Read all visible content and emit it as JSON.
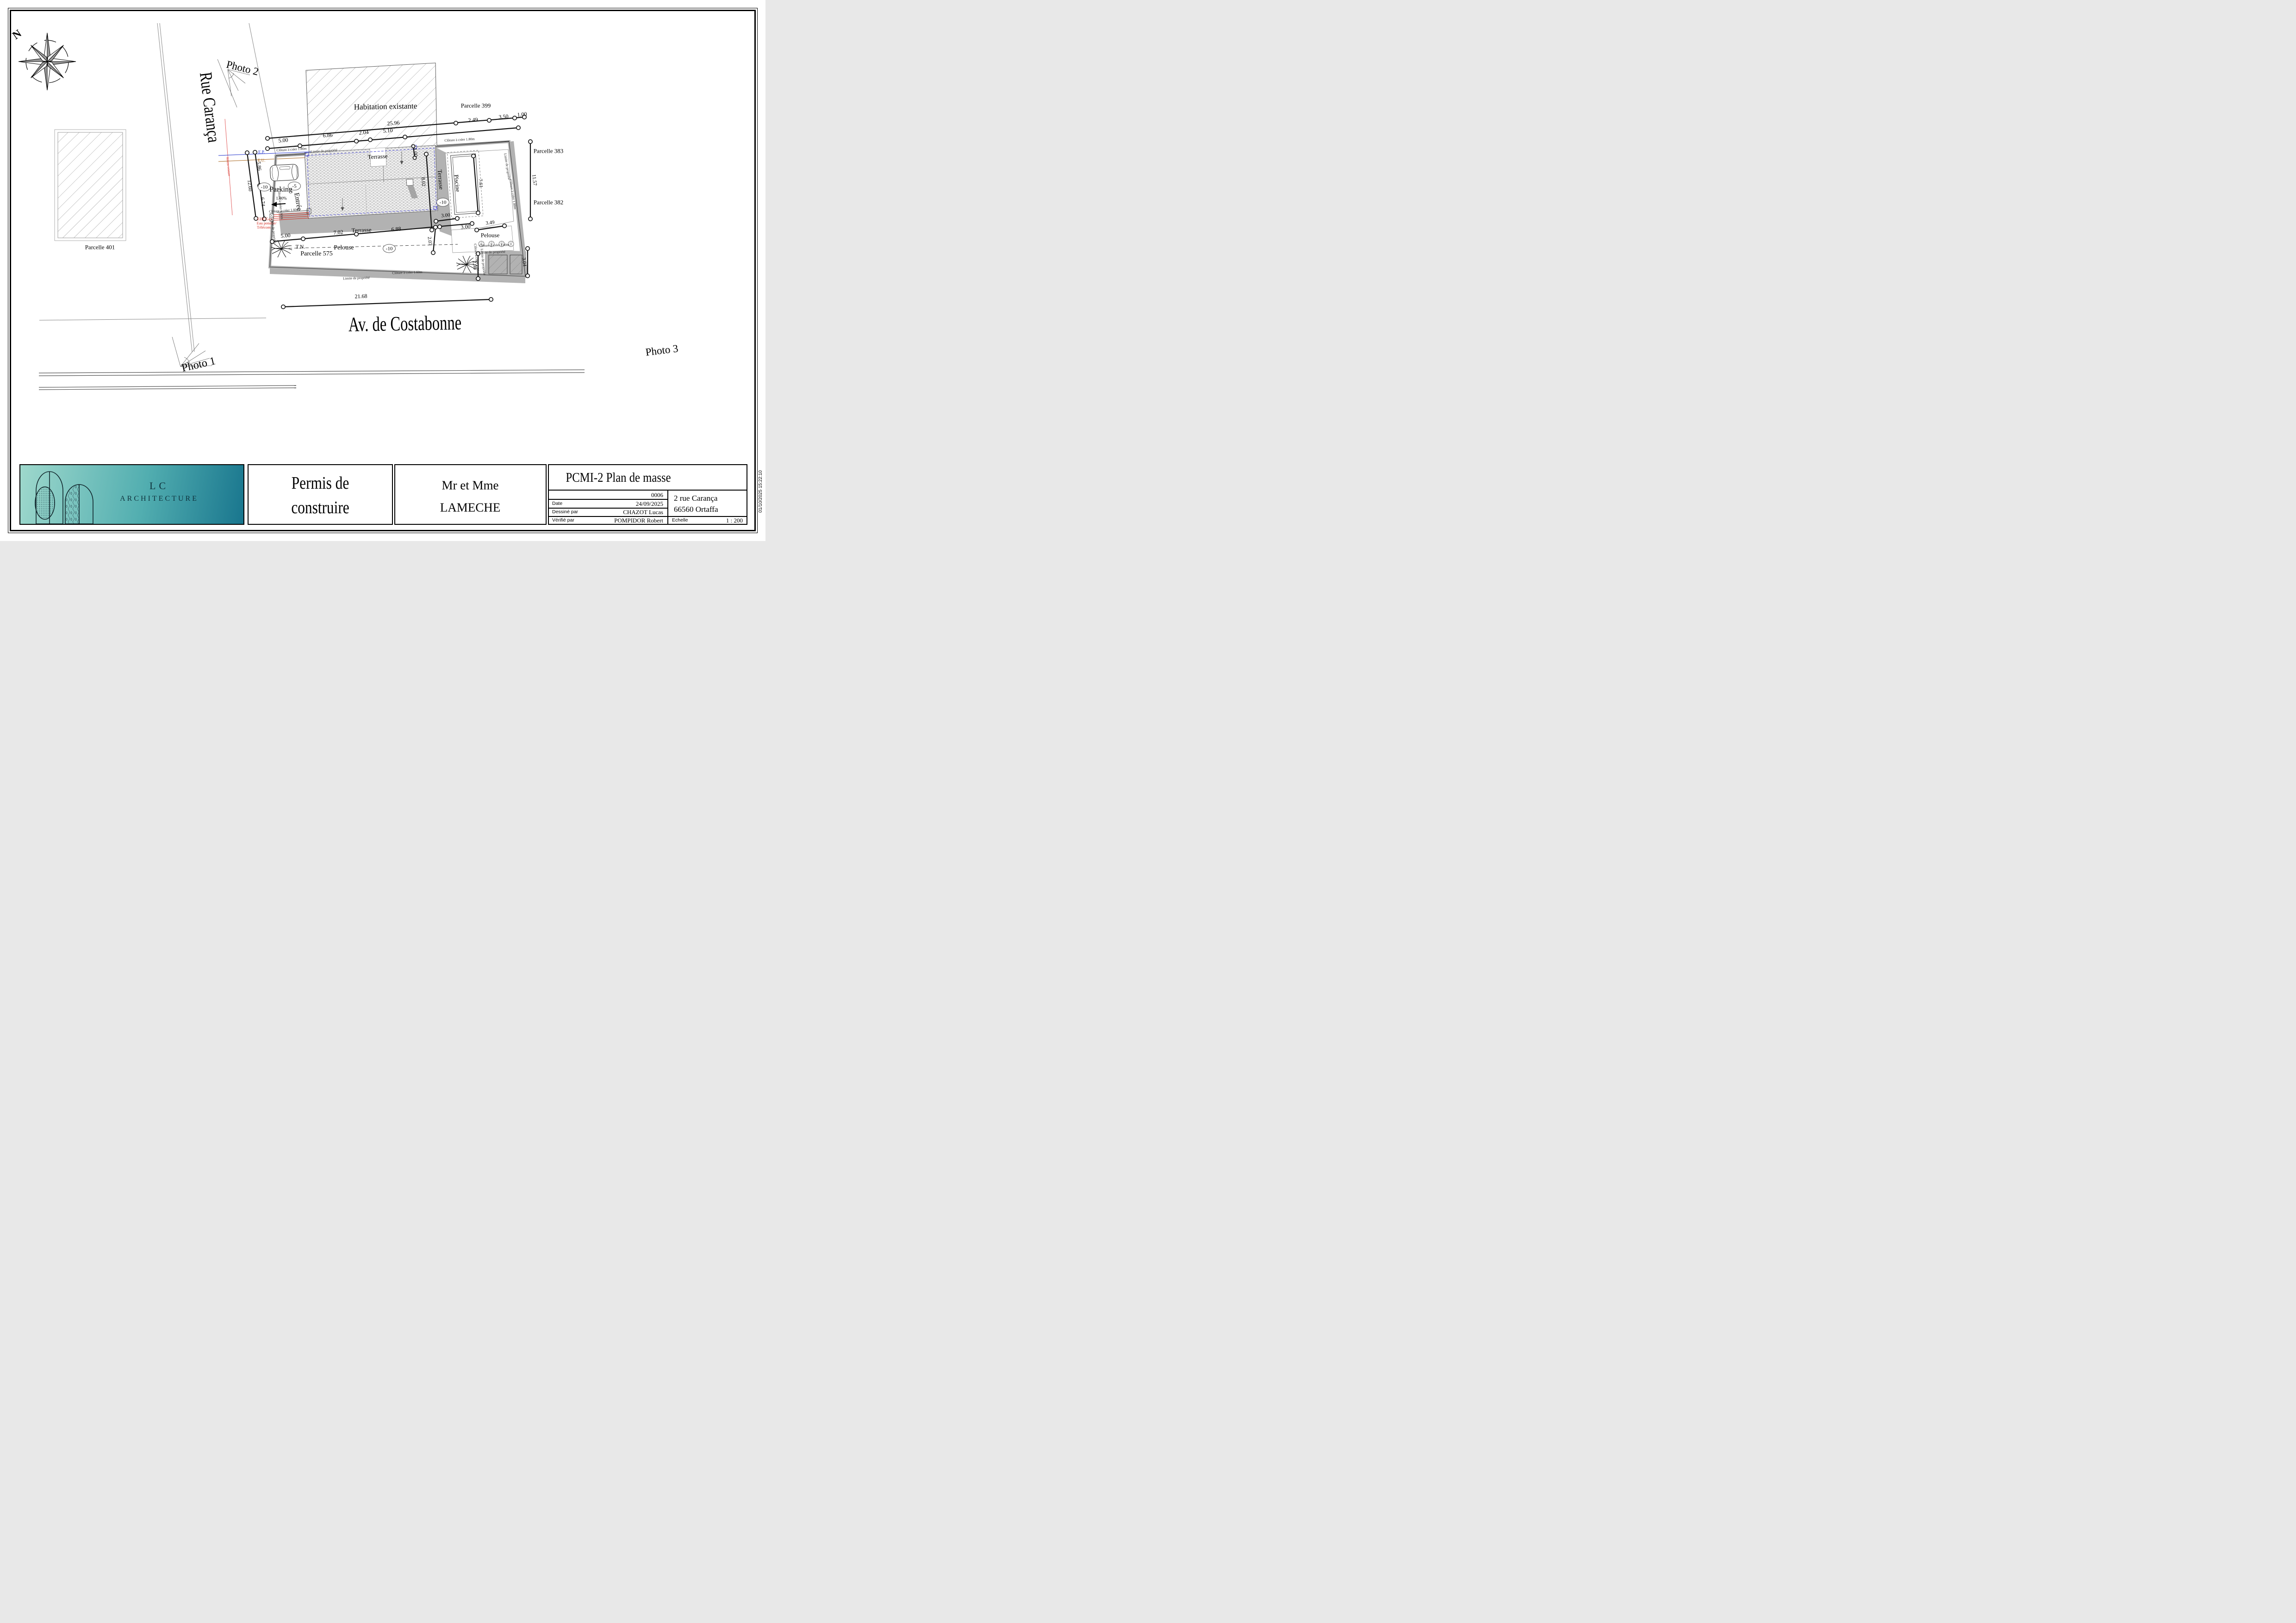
{
  "meta": {
    "timestamp": "01/10/2025 15:22:10"
  },
  "compass": {
    "north": "N"
  },
  "streets": {
    "rue_caranca": "Rue Carança",
    "av_costabonne": "Av. de Costabonne"
  },
  "photos": {
    "p1": "Photo 1",
    "p2": "Photo 2",
    "p3": "Photo 3"
  },
  "parcels": {
    "p399": "Parcelle 399",
    "p383": "Parcelle 383",
    "p382": "Parcelle 382",
    "p401": "Parcelle 401",
    "p575": "Parcelle 575"
  },
  "labels": {
    "habitation": "Habitation existante",
    "terrasse": "Terrasse",
    "parking": "Parking",
    "entree": "Entrée",
    "piscine": "Piscine",
    "pelouse": "Pelouse",
    "tn": "T.N.",
    "slope": "1.00%",
    "level_m10": "-10",
    "level_m5": "-5",
    "cloture_180": "Clôture à créer 1.80m",
    "cloture_160": "Clôture à créer 1.60m",
    "limite": "Limite de propriété",
    "ep": "E.P.",
    "eu": "E.U.",
    "edf": "EDF/Gaz/",
    "eau": "Eau potable/",
    "telecom": "Télécom",
    "reseau": "Réseau existant"
  },
  "dims": {
    "d2596": "25.96",
    "d500": "5.00",
    "d686": "6.86",
    "d204": "2.04",
    "d510": "5.10",
    "d249": "2.49",
    "d350": "3.50",
    "d100": "1.00",
    "d586": "5.86",
    "d1260": "12.60",
    "d674": "6.74",
    "d802": "8.02",
    "d207": "2.07",
    "d1157": "11.57",
    "d761": "7.61",
    "d349": "3.49",
    "d300": "3.00",
    "d298": "2.98",
    "d304": "3.04",
    "d702": "7.02",
    "d688": "6.88",
    "d2168": "21.68"
  },
  "titleblock": {
    "logo_line1": "LC",
    "logo_line2": "ARCHITECTURE",
    "doc_line1": "Permis de",
    "doc_line2": "construire",
    "client_line1": "Mr et Mme",
    "client_line2": "LAMECHE",
    "sheet_title": "PCMI-2 Plan de masse",
    "sheet_number": "0006",
    "date_label": "Date",
    "date_value": "24/09/2025",
    "drawn_label": "Dessiné par",
    "drawn_value": "CHAZOT Lucas",
    "checked_label": "Vérifié par",
    "checked_value": "POMPIDOR Robert",
    "scale_label": "Echelle",
    "scale_value": "1 : 200",
    "address_line1": "2 rue Carança",
    "address_line2": "66560 Ortaffa"
  }
}
